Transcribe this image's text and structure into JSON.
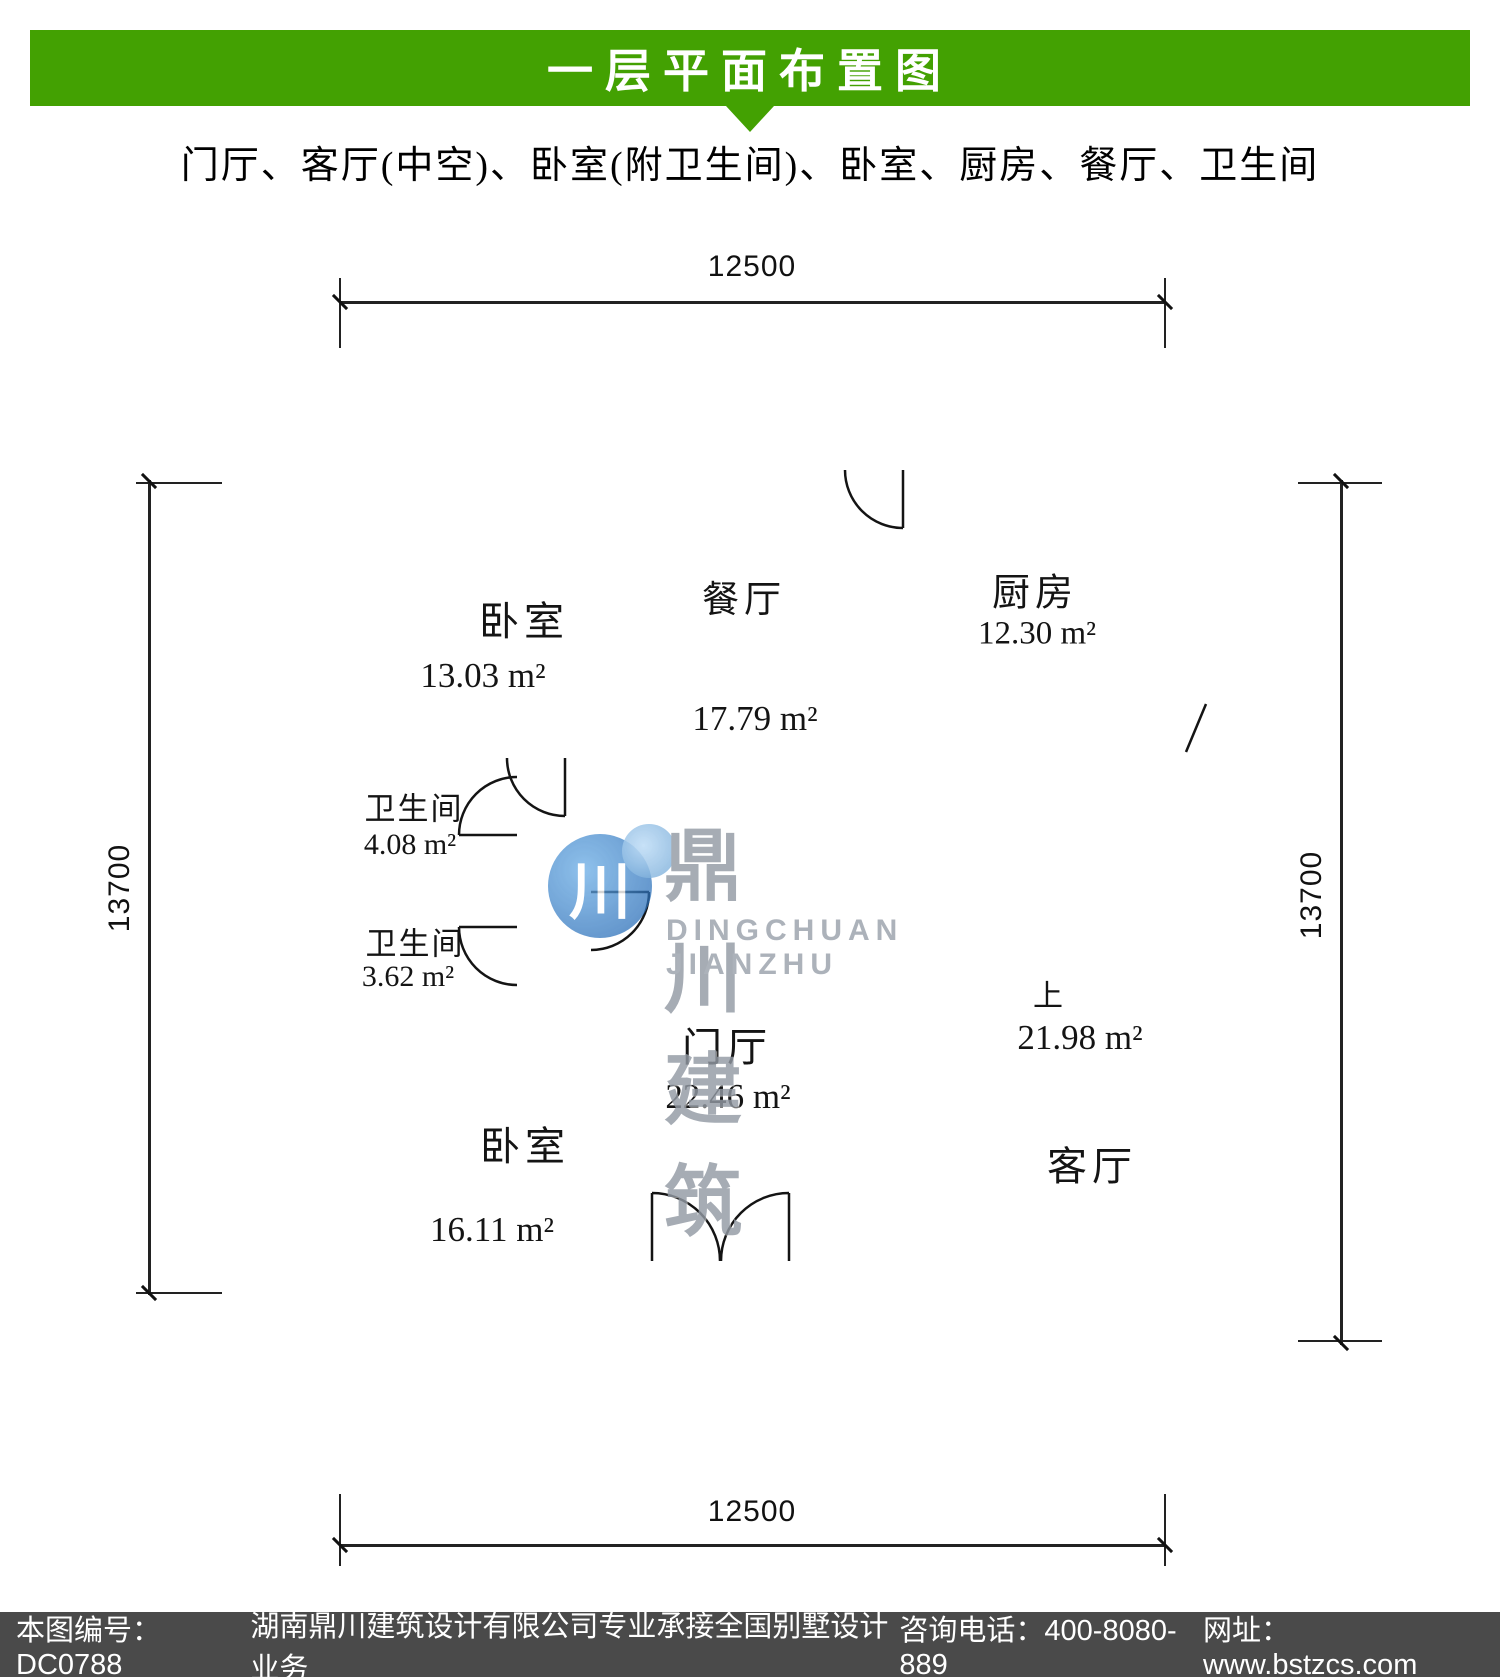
{
  "header": {
    "title": "一层平面布置图",
    "subtitle": "门厅、客厅(中空)、卧室(附卫生间)、卧室、厨房、餐厅、卫生间"
  },
  "rooms": {
    "bedroom1": {
      "label": "卧室",
      "area": "13.03 m²"
    },
    "dining": {
      "label": "餐厅",
      "area": "17.79 m²"
    },
    "kitchen": {
      "label": "厨房",
      "area": "12.30 m²"
    },
    "bath1": {
      "label": "卫生间",
      "area": "4.08 m²"
    },
    "bath2": {
      "label": "卫生间",
      "area": "3.62 m²"
    },
    "bedroom2": {
      "label": "卧室",
      "area": "16.11 m²"
    },
    "foyer": {
      "label": "门厅",
      "area": "22.46 m²"
    },
    "living": {
      "label": "客厅",
      "area": "21.98 m²"
    }
  },
  "stairs": {
    "up_label": "上"
  },
  "dims": {
    "top": "12500",
    "bottom": "12500",
    "left": "13700",
    "right": "13700"
  },
  "watermark": {
    "logo_char": "川",
    "cn": "鼎川建筑",
    "en": "DINGCHUAN JIANZHU"
  },
  "footer": {
    "code": "本图编号：DC0788",
    "company": "湖南鼎川建筑设计有限公司专业承接全国别墅设计业务",
    "phone": "咨询电话：400-8080-889",
    "website": "网址：www.bstzcs.com"
  },
  "colors": {
    "banner_green": "#43a102",
    "footer_bg": "#4a4a4a",
    "wall_black": "#101010"
  }
}
